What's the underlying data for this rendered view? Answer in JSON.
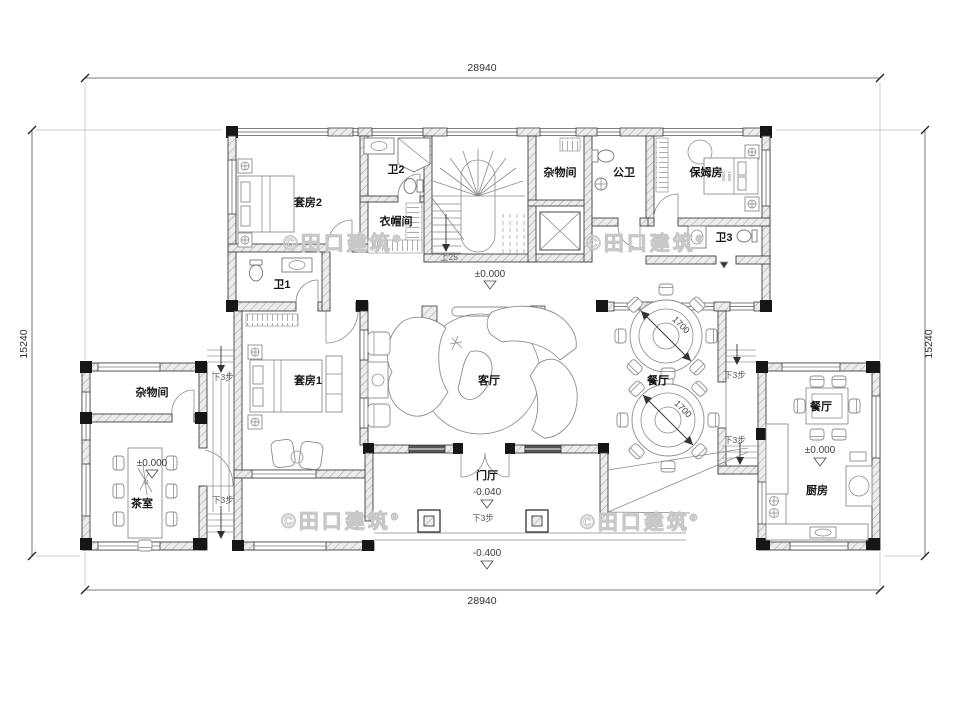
{
  "dimensions": {
    "top": "28940",
    "bottom": "28940",
    "left": "15240",
    "right": "15240"
  },
  "rooms": {
    "suite2": "套房2",
    "bath2": "卫2",
    "cloakroom": "衣帽间",
    "storage_top": "杂物间",
    "public_bath": "公卫",
    "nanny_room": "保姆房",
    "bath3": "卫3",
    "bath1": "卫1",
    "suite1": "套房1",
    "living": "客厅",
    "dining": "餐厅",
    "entrance": "门厅",
    "storage_left": "杂物间",
    "tea_room": "茶室",
    "dining_right": "餐厅",
    "kitchen": "厨房"
  },
  "elevations": {
    "zero": "±0.000",
    "entry": "-0.040",
    "ground": "-0.400"
  },
  "stairs": {
    "up": "上25",
    "down3": "下3步"
  },
  "tables": {
    "round_diameter": "1700"
  },
  "bed_dims": {
    "width": "1800",
    "length": "2000"
  },
  "watermark": {
    "text": "©田口建筑",
    "reg": "®"
  },
  "colors": {
    "wall_hatch": "#b5b5b5",
    "line": "#3f3f3f",
    "furniture": "#8d8d8d",
    "watermark": "#c8c8c8",
    "column": "#161616"
  }
}
